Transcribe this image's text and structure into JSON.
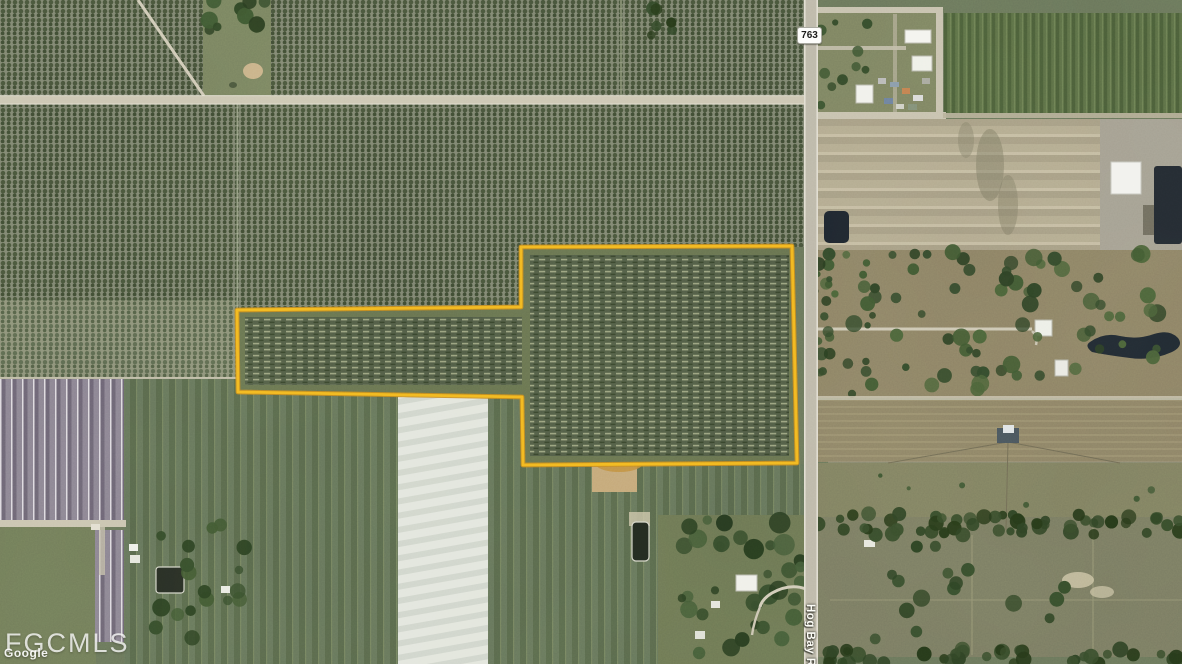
{
  "map": {
    "watermark": "FGCMLS",
    "attribution": "Google",
    "route_shield_label": "763",
    "road_name_label": "Hog Bay Rd",
    "boundary": {
      "color": "#F2B61F",
      "casing_color": "#C8891B",
      "points": "237,310 521,307 521,247 792,246 797,463 523,465 522,397 238,392"
    }
  }
}
